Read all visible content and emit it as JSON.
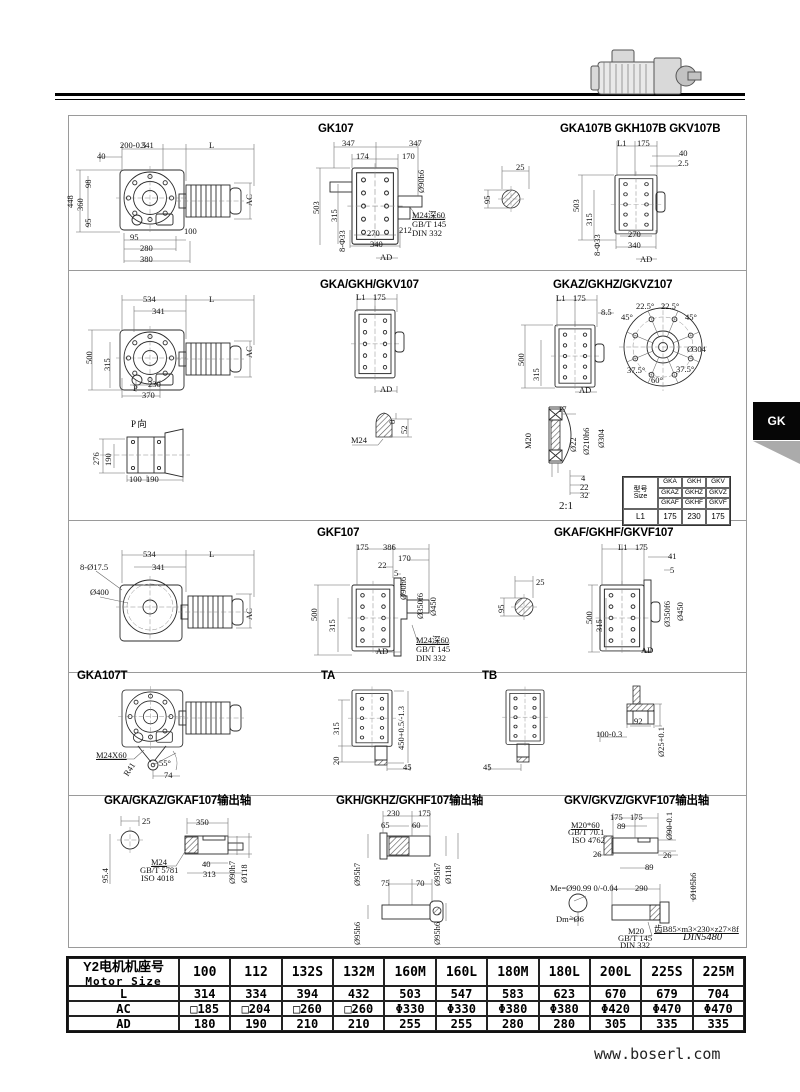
{
  "side_tab": {
    "label": "GK"
  },
  "footer": {
    "website": "www.boserl.com"
  },
  "titles": {
    "s1_left": "GK107",
    "s1_right": "GKA107B GKH107B GKV107B",
    "s2_mid": "GKA/GKH/GKV107",
    "s2_right": "GKAZ/GKHZ/GKVZ107",
    "s2_p": "P 向",
    "s2_scale": "2:1",
    "s3_mid": "GKF107",
    "s3_right": "GKAF/GKHF/GKVF107",
    "s4_left": "GKA107T",
    "s4_ta": "TA",
    "s4_tb": "TB",
    "s5_left": "GKA/GKAZ/GKAF107输出轴",
    "s5_mid": "GKH/GKHZ/GKHF107输出轴",
    "s5_right": "GKV/GKVZ/GKVF107输出轴"
  },
  "dims": {
    "gk107_front": [
      "200-0.5",
      "341",
      "L",
      "40",
      "98",
      "448",
      "360",
      "95",
      "95",
      "100",
      "280",
      "380",
      "AC"
    ],
    "gk107_side": [
      "347",
      "347",
      "174",
      "170",
      "Ø90h6",
      "503",
      "315",
      "8-Φ33",
      "270",
      "212",
      "340",
      "AD",
      "M24深60",
      "GB/T 145",
      "DIN 332"
    ],
    "shaft1": [
      "25",
      "95"
    ],
    "gka107b": [
      "L1",
      "175",
      "40",
      "2.5",
      "503",
      "315",
      "8-Φ33",
      "270",
      "340",
      "AD"
    ],
    "gka_front": [
      "534",
      "L",
      "341",
      "500",
      "315",
      "230",
      "P",
      "370",
      "AC"
    ],
    "gka_side": [
      "L1",
      "175",
      "AD"
    ],
    "gkaz": [
      "L1",
      "175",
      "8.5",
      "500",
      "315",
      "AD"
    ],
    "gkaz_flange": [
      "22.5°",
      "22.5°",
      "45°",
      "45°",
      "Ø304",
      "37.5°",
      "37.5°",
      "60°"
    ],
    "p_view": [
      "276",
      "190",
      "100",
      "190"
    ],
    "m24": [
      "8",
      "52",
      "M24"
    ],
    "m20": [
      "17",
      "M20",
      "Ø22",
      "Ø210h6",
      "Ø304",
      "4",
      "22",
      "32"
    ],
    "gkf_front": [
      "534",
      "L",
      "8-Ø17.5",
      "341",
      "Ø400",
      "AC"
    ],
    "gkf_side": [
      "175",
      "386",
      "170",
      "22",
      "5",
      "Ø90h6",
      "Ø350f6",
      "Ø450",
      "500",
      "315",
      "AD",
      "M24深60",
      "GB/T 145",
      "DIN 332"
    ],
    "shaft3": [
      "25",
      "95"
    ],
    "gkaf": [
      "L1",
      "175",
      "41",
      "5",
      "500",
      "315",
      "Ø350f6",
      "Ø450",
      "AD"
    ],
    "gka107t": [
      "M24X60",
      "R41",
      "55°",
      "74"
    ],
    "ta": [
      "315",
      "450+0.5/-1.3",
      "20",
      "45"
    ],
    "tb": [
      "45"
    ],
    "t_detail": [
      "92",
      "100-0.3",
      "Ø25+0.1"
    ],
    "gka_shaft": [
      "25",
      "350",
      "95.4",
      "M24",
      "GB/T 5781",
      "ISO 4018",
      "40",
      "313",
      "Ø90h7",
      "Ø118"
    ],
    "gkh_shaft": [
      "230",
      "175",
      "65",
      "60",
      "Ø95h7",
      "Ø95h7",
      "Ø118",
      "75",
      "70",
      "Ø95h6",
      "Ø95h6"
    ],
    "gkv_shaft": [
      "175",
      "175",
      "89",
      "Ø90-0.1",
      "M20*60",
      "GB/T 70.1",
      "ISO 4762",
      "26",
      "26",
      "89",
      "290",
      "Ø105h6",
      "Me=Ø90.99 0/-0.04",
      "Dm=Ø6",
      "M20",
      "GB/T 145",
      "DIN 332",
      "齿B85×m3×230×z27×8f",
      "DIN5480"
    ]
  },
  "type_table": {
    "header_cn": "型号",
    "header_en": "Size",
    "rows": [
      [
        "GKA",
        "GKH",
        "GKV"
      ],
      [
        "GKAZ",
        "GKHZ",
        "GKVZ"
      ],
      [
        "GKAF",
        "GKHF",
        "GKVF"
      ]
    ],
    "l1_label": "L1",
    "l1": [
      "175",
      "230",
      "175"
    ]
  },
  "motor_table": {
    "header_cn": "Y2电机机座号",
    "header_en": "Motor Size",
    "columns": [
      "100",
      "112",
      "132S",
      "132M",
      "160M",
      "160L",
      "180M",
      "180L",
      "200L",
      "225S",
      "225M"
    ],
    "rows": [
      {
        "label": "L",
        "values": [
          "314",
          "334",
          "394",
          "432",
          "503",
          "547",
          "583",
          "623",
          "670",
          "679",
          "704"
        ]
      },
      {
        "label": "AC",
        "values": [
          "□185",
          "□204",
          "□260",
          "□260",
          "Φ330",
          "Φ330",
          "Φ380",
          "Φ380",
          "Φ420",
          "Φ470",
          "Φ470"
        ]
      },
      {
        "label": "AD",
        "values": [
          "180",
          "190",
          "210",
          "210",
          "255",
          "255",
          "280",
          "280",
          "305",
          "335",
          "335"
        ]
      }
    ]
  }
}
